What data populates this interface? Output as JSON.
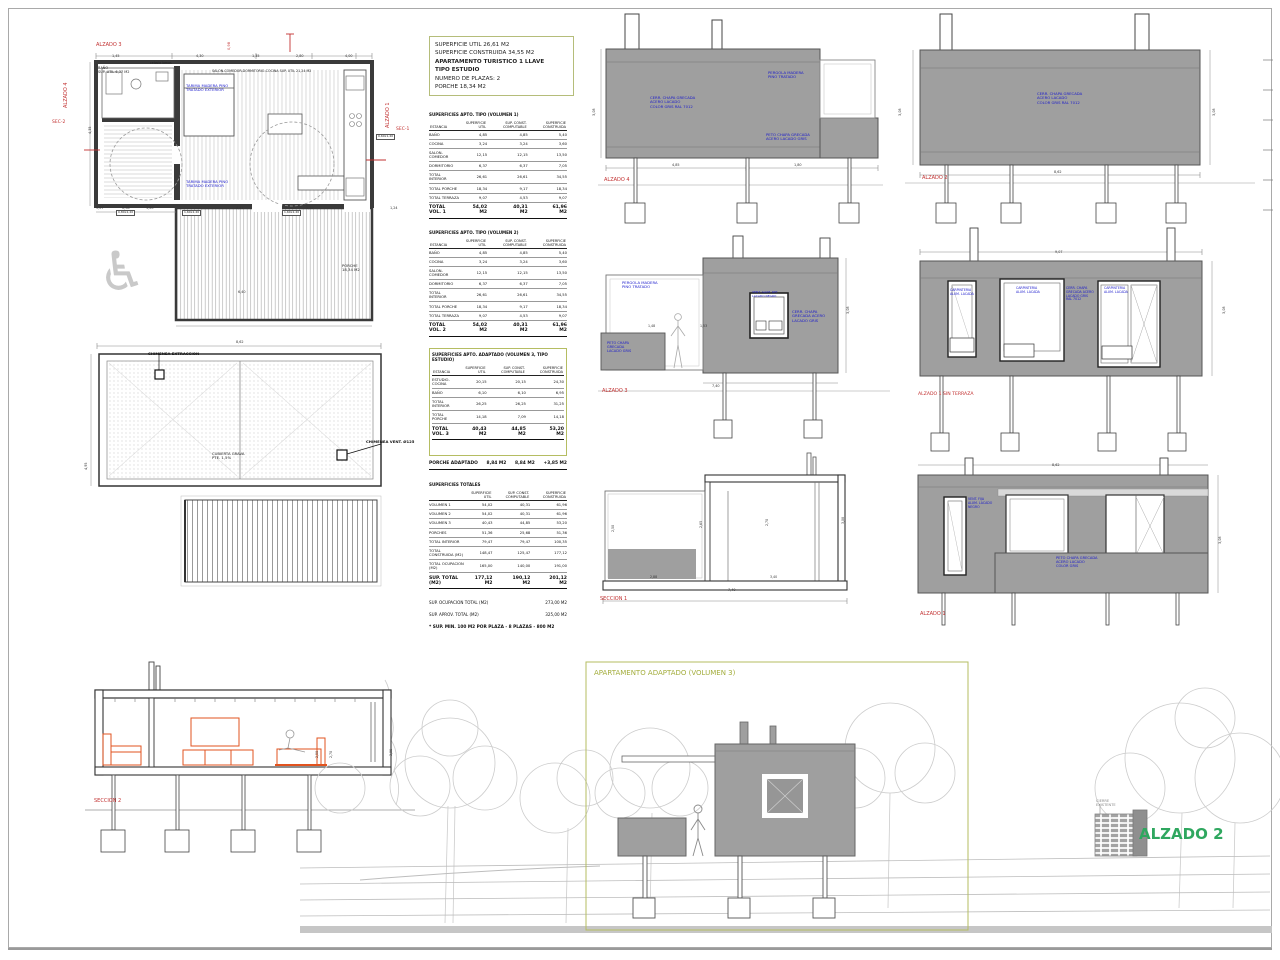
{
  "colors": {
    "red": "#c23030",
    "blue": "#1a1acc",
    "olive": "#a3ad3c",
    "green": "#2fa75f",
    "wall": "#9f9f9f",
    "orange": "#e2531f"
  },
  "summary": {
    "lines": [
      "SUPERFICIE UTIL 26,61 M2",
      "SUPERFICIE CONSTRUIDA 34,55 M2",
      "APARTAMENTO TURISTICO 1 LLAVE",
      "TIPO ESTUDIO",
      "NUMERO DE PLAZAS: 2",
      "PORCHE 18,34 M2"
    ]
  },
  "table_order": [
    "t1",
    "t2",
    "t3",
    "t4"
  ],
  "tables": {
    "t1": {
      "name": "surface-table-vol1",
      "title": "SUPERFICIES APTO. TIPO (VOLUMEN 1)",
      "unit": "M2",
      "col_headers": [
        "ESTANCIA",
        "SUPERFICIE UTIL",
        "SUP. CONST. COMPUTABLE",
        "SUPERFICIE CONSTRUIDA"
      ],
      "rows": [
        [
          "BAÑO",
          "4,85",
          "4,85",
          "5,40"
        ],
        [
          "COCINA",
          "3,24",
          "3,24",
          "3,60"
        ],
        [
          "SALON-COMEDOR",
          "12,15",
          "12,15",
          "13,50"
        ],
        [
          "DORMITORIO",
          "6,37",
          "6,37",
          "7,05"
        ],
        [
          "TOTAL INTERIOR",
          "26,61",
          "26,61",
          "34,55"
        ],
        [
          "TOTAL PORCHE",
          "18,34",
          "9,17",
          "18,34"
        ],
        [
          "TOTAL TERRAZA",
          "9,07",
          "4,53",
          "9,07"
        ]
      ],
      "total": {
        "label": "TOTAL\nVOL. 1",
        "values": [
          "54,02",
          "40,31",
          "61,96"
        ]
      }
    },
    "t2": {
      "name": "surface-table-vol2",
      "title": "SUPERFICIES APTO. TIPO (VOLUMEN 2)",
      "unit": "M2",
      "col_headers": [
        "ESTANCIA",
        "SUPERFICIE UTIL",
        "SUP. CONST. COMPUTABLE",
        "SUPERFICIE CONSTRUIDA"
      ],
      "rows": [
        [
          "BAÑO",
          "4,85",
          "4,85",
          "5,40"
        ],
        [
          "COCINA",
          "3,24",
          "3,24",
          "3,60"
        ],
        [
          "SALON-COMEDOR",
          "12,15",
          "12,15",
          "13,50"
        ],
        [
          "DORMITORIO",
          "6,37",
          "6,37",
          "7,05"
        ],
        [
          "TOTAL INTERIOR",
          "26,61",
          "26,61",
          "34,55"
        ],
        [
          "TOTAL PORCHE",
          "18,34",
          "9,17",
          "18,34"
        ],
        [
          "TOTAL TERRAZA",
          "9,07",
          "4,53",
          "9,07"
        ]
      ],
      "total": {
        "label": "TOTAL\nVOL. 2",
        "values": [
          "54,02",
          "40,31",
          "61,96"
        ]
      }
    },
    "t3": {
      "name": "surface-table-vol3",
      "boxed": true,
      "title": "SUPERFICIES APTO. ADAPTADO (VOLUMEN 3, TIPO ESTUDIO)",
      "unit": "M2",
      "col_headers": [
        "ESTANCIA",
        "SUPERFICIE UTIL",
        "SUP. CONST. COMPUTABLE",
        "SUPERFICIE CONSTRUIDA"
      ],
      "rows": [
        [
          "ESTUDIO-COCINA",
          "20,15",
          "20,15",
          "24,30"
        ],
        [
          "BAÑO",
          "6,10",
          "6,10",
          "6,95"
        ],
        [
          "TOTAL INTERIOR",
          "26,25",
          "26,25",
          "31,25"
        ],
        [
          "TOTAL PORCHE",
          "14,18",
          "7,09",
          "14,18"
        ]
      ],
      "total": {
        "label": "TOTAL\nVOL. 3",
        "values": [
          "40,43",
          "44,85",
          "53,20"
        ]
      },
      "extra_row": [
        "PORCHE ADAPTADO",
        "8,84 M2",
        "8,84 M2",
        "+3,85 M2"
      ]
    },
    "t4": {
      "name": "surface-table-totals",
      "title": "SUPERFICIES TOTALES",
      "unit": "M2",
      "col_headers": [
        "",
        "SUPERFICIE UTIL",
        "SUP. CONST. COMPUTABLE",
        "SUPERFICIE CONSTRUIDA"
      ],
      "rows": [
        [
          "VOLUMEN 1",
          "54,02",
          "40,31",
          "61,96"
        ],
        [
          "VOLUMEN 2",
          "54,02",
          "40,31",
          "61,96"
        ],
        [
          "VOLUMEN 3",
          "40,43",
          "44,85",
          "53,20"
        ],
        [
          "PORCHES",
          "51,36",
          "25,68",
          "51,36"
        ],
        [
          "TOTAL INTERIOR",
          "79,47",
          "79,47",
          "100,35"
        ],
        [
          "TOTAL CONSTRUIDA (M2)",
          "148,47",
          "125,47",
          "177,12"
        ],
        [
          "TOTAL OCUPACION (M2)",
          "165,00",
          "140,00",
          "191,00"
        ]
      ],
      "total": {
        "label": "SUP. TOTAL\n(M2)",
        "values": [
          "177,12",
          "190,12",
          "201,12"
        ]
      },
      "footer_lines": [
        [
          "SUP. OCUPACION TOTAL (M2)",
          "273,00 M2"
        ],
        [
          "SUP. APROV. TOTAL (M2)",
          "325,00 M2"
        ]
      ],
      "final_line": "* SUP. MIN. 100 M2 POR PLAZA - 8 PLAZAS - 800 M2"
    }
  },
  "labels": [
    {
      "n": "plan-alzado3-label",
      "t": "ALZADO 3",
      "x": 96,
      "y": 43,
      "s": 5,
      "c": "red"
    },
    {
      "n": "plan-alzado4-label",
      "t": "ALZADO 4",
      "x": 64,
      "y": 108,
      "s": 5,
      "c": "red",
      "r": -90
    },
    {
      "n": "plan-alzado1-label",
      "t": "ALZADO 1",
      "x": 386,
      "y": 128,
      "s": 5,
      "c": "red",
      "r": -90
    },
    {
      "n": "plan-sec2-label",
      "t": "SEC-2",
      "x": 52,
      "y": 120,
      "s": 4.5,
      "c": "red"
    },
    {
      "n": "plan-sec1-label",
      "t": "SEC-1",
      "x": 396,
      "y": 127,
      "s": 4.5,
      "c": "red"
    },
    {
      "n": "plan-red-dim",
      "t": "0,98",
      "x": 227,
      "y": 50,
      "s": 3.6,
      "c": "red",
      "r": -90
    },
    {
      "n": "plan-bano-label",
      "t": "BAÑO\nSUP. UTIL 6,37 M2",
      "x": 98,
      "y": 66,
      "s": 3.5,
      "c": "#222"
    },
    {
      "n": "plan-salon-label",
      "t": "SALON-COMEDOR-DORMITORIO-COCINA  SUP. UTIL 21,24 M2",
      "x": 212,
      "y": 70,
      "s": 3.3,
      "c": "#222"
    },
    {
      "n": "plan-celosia-label",
      "t": "celosia lamas",
      "x": 150,
      "y": 62,
      "s": 3.2,
      "c": "#222"
    },
    {
      "n": "plan-note-1",
      "t": "TARIMA MADERA PINO\nTRATADO EXTERIOR",
      "x": 186,
      "y": 84,
      "s": 3.8,
      "c": "blue"
    },
    {
      "n": "plan-note-2",
      "t": "TARIMA MADERA PINO\nTRATADO EXTERIOR",
      "x": 186,
      "y": 180,
      "s": 3.8,
      "c": "blue"
    },
    {
      "n": "plan-porche-label",
      "t": "PORCHE\n18,34 M2",
      "x": 342,
      "y": 264,
      "s": 3.8,
      "c": "#222"
    },
    {
      "n": "dim",
      "t": "5,07",
      "x": 96,
      "y": 206,
      "s": 3.4
    },
    {
      "n": "dim",
      "t": "0,98",
      "x": 122,
      "y": 206,
      "s": 3.4
    },
    {
      "n": "dim",
      "t": "1,20",
      "x": 146,
      "y": 206,
      "s": 3.4
    },
    {
      "n": "dim",
      "t": "4,47",
      "x": 236,
      "y": 206,
      "s": 3.4
    },
    {
      "n": "dim",
      "t": "1,39",
      "x": 306,
      "y": 206,
      "s": 3.4
    },
    {
      "n": "dim",
      "t": "1,24",
      "x": 390,
      "y": 206,
      "s": 3.4
    },
    {
      "n": "dim",
      "t": "1,45",
      "x": 112,
      "y": 54,
      "s": 3.4
    },
    {
      "n": "dim",
      "t": "4,30",
      "x": 196,
      "y": 54,
      "s": 3.4
    },
    {
      "n": "dim",
      "t": "1,35",
      "x": 252,
      "y": 54,
      "s": 3.4
    },
    {
      "n": "dim",
      "t": "2,80",
      "x": 296,
      "y": 54,
      "s": 3.4
    },
    {
      "n": "dim",
      "t": "4,00",
      "x": 345,
      "y": 54,
      "s": 3.4
    },
    {
      "n": "dim",
      "t": "4,35",
      "x": 88,
      "y": 134,
      "s": 3.4,
      "r": -90
    },
    {
      "n": "dim",
      "t": "6,40",
      "x": 238,
      "y": 290,
      "s": 3.4
    },
    {
      "n": "door-chip",
      "t": "1,60x2,20",
      "x": 182,
      "y": 210,
      "s": 3,
      "c": "#222",
      "chip": 1
    },
    {
      "n": "door-chip",
      "t": "1,60x2,20",
      "x": 282,
      "y": 210,
      "s": 3,
      "c": "#222",
      "chip": 1
    },
    {
      "n": "door-chip",
      "t": "0,80x2,20",
      "x": 116,
      "y": 210,
      "s": 3,
      "c": "#222",
      "chip": 1
    },
    {
      "n": "window-chip",
      "t": "0,60x1,20",
      "x": 376,
      "y": 134,
      "s": 3,
      "c": "#222",
      "chip": 1
    },
    {
      "n": "wheelchair-icon",
      "t": "♿",
      "x": 98,
      "y": 240,
      "s": 54,
      "c": "#c9c9c9"
    },
    {
      "n": "roof-chimenea1-label",
      "t": "CHIMENEA EXTRACCION",
      "x": 148,
      "y": 352,
      "s": 3.8,
      "c": "#111",
      "b": 1
    },
    {
      "n": "roof-chimenea2-label",
      "t": "CHIMENEA VENT. Ø125",
      "x": 366,
      "y": 440,
      "s": 3.8,
      "c": "#111",
      "b": 1
    },
    {
      "n": "roof-center-label",
      "t": "CUBIERTA GRAVA\nPTE. 1,5%",
      "x": 212,
      "y": 452,
      "s": 3.8,
      "c": "#222"
    },
    {
      "n": "dim",
      "t": "8,62",
      "x": 236,
      "y": 340,
      "s": 3.4
    },
    {
      "n": "dim",
      "t": "4,95",
      "x": 84,
      "y": 470,
      "s": 3.4,
      "r": -90
    },
    {
      "n": "seccion2-label",
      "t": "SECCION 2",
      "x": 94,
      "y": 799,
      "s": 5,
      "c": "red"
    },
    {
      "n": "dim",
      "t": "2,50",
      "x": 316,
      "y": 758,
      "s": 3.2,
      "r": -90
    },
    {
      "n": "dim",
      "t": "2,70",
      "x": 330,
      "y": 758,
      "s": 3.2,
      "r": -90
    },
    {
      "n": "dim",
      "t": "3,08",
      "x": 390,
      "y": 756,
      "s": 3.2,
      "r": -90
    },
    {
      "n": "alzado4-label",
      "t": "ALZADO 4",
      "x": 604,
      "y": 178,
      "s": 5,
      "c": "red"
    },
    {
      "n": "alzado4-note1",
      "t": "CERR. CHAPA GRECADA\nACERO LACADO\nCOLOR GRIS RAL 7012",
      "x": 650,
      "y": 96,
      "s": 3.8,
      "c": "blue"
    },
    {
      "n": "alzado4-note2",
      "t": "PERGOLA MADERA\nPINO TRATADO",
      "x": 768,
      "y": 71,
      "s": 3.8,
      "c": "blue"
    },
    {
      "n": "alzado4-note3",
      "t": "PETO CHAPA GRECADA\nACERO LACADO GRIS",
      "x": 766,
      "y": 133,
      "s": 3.8,
      "c": "blue"
    },
    {
      "n": "dim",
      "t": "4,85",
      "x": 672,
      "y": 163,
      "s": 3.4
    },
    {
      "n": "dim",
      "t": "1,80",
      "x": 794,
      "y": 163,
      "s": 3.4
    },
    {
      "n": "dim",
      "t": "3,08",
      "x": 592,
      "y": 116,
      "s": 3.4,
      "r": -90
    },
    {
      "n": "alzado2-elev-label",
      "t": "ALZADO 2",
      "x": 922,
      "y": 176,
      "s": 5,
      "c": "red"
    },
    {
      "n": "alzado2-note",
      "t": "CERR. CHAPA GRECADA\nACERO LACADO\nCOLOR GRIS RAL 7012",
      "x": 1037,
      "y": 92,
      "s": 3.8,
      "c": "blue"
    },
    {
      "n": "dim",
      "t": "8,62",
      "x": 1054,
      "y": 170,
      "s": 3.4
    },
    {
      "n": "dim",
      "t": "3,08",
      "x": 898,
      "y": 116,
      "s": 3.4,
      "r": -90
    },
    {
      "n": "dim",
      "t": "3,08",
      "x": 1212,
      "y": 116,
      "s": 3.4,
      "r": -90
    },
    {
      "n": "alzado3-label",
      "t": "ALZADO 3",
      "x": 602,
      "y": 389,
      "s": 5,
      "c": "red"
    },
    {
      "n": "alzado3-note1",
      "t": "PERGOLA MADERA\nPINO TRATADO",
      "x": 622,
      "y": 281,
      "s": 3.8,
      "c": "blue"
    },
    {
      "n": "alzado3-note2",
      "t": "VENT. ALUM. RPT\nLACADO NEGRO",
      "x": 752,
      "y": 291,
      "s": 3,
      "c": "blue"
    },
    {
      "n": "alzado3-note3",
      "t": "CERR. CHAPA\nGRECADA ACERO\nLACADO GRIS",
      "x": 792,
      "y": 310,
      "s": 3.8,
      "c": "blue"
    },
    {
      "n": "alzado3-note4",
      "t": "PETO CHAPA\nGRECADA\nLACADO GRIS",
      "x": 607,
      "y": 341,
      "s": 3.5,
      "c": "blue"
    },
    {
      "n": "dim",
      "t": "1,48",
      "x": 648,
      "y": 325,
      "s": 3.2
    },
    {
      "n": "dim",
      "t": "1,53",
      "x": 700,
      "y": 325,
      "s": 3.2
    },
    {
      "n": "dim",
      "t": "7,40",
      "x": 712,
      "y": 384,
      "s": 3.4
    },
    {
      "n": "dim",
      "t": "3,08",
      "x": 846,
      "y": 314,
      "s": 3.4,
      "r": -90
    },
    {
      "n": "alzado1st-label",
      "t": "ALZADO 1 SIN TERRAZA",
      "x": 918,
      "y": 392,
      "s": 4.6,
      "c": "red"
    },
    {
      "n": "dim",
      "t": "9,07",
      "x": 1055,
      "y": 250,
      "s": 3.4
    },
    {
      "n": "alzado1st-note1",
      "t": "CARPINTERIA\nALUM. LACADA",
      "x": 950,
      "y": 289,
      "s": 3.2,
      "c": "blue"
    },
    {
      "n": "alzado1st-note2",
      "t": "CARPINTERIA\nALUM. LACADA",
      "x": 1016,
      "y": 287,
      "s": 3.2,
      "c": "blue"
    },
    {
      "n": "alzado1st-note3",
      "t": "CERR. CHAPA\nGRECADA ACERO\nLACADO GRIS\nRAL 7012",
      "x": 1066,
      "y": 287,
      "s": 3.2,
      "c": "blue"
    },
    {
      "n": "alzado1st-note4",
      "t": "CARPINTERIA\nALUM. LACADA",
      "x": 1104,
      "y": 287,
      "s": 3.2,
      "c": "blue"
    },
    {
      "n": "dim",
      "t": "3,08",
      "x": 1222,
      "y": 314,
      "s": 3.4,
      "r": -90
    },
    {
      "n": "seccion1-label",
      "t": "SECCION 1",
      "x": 600,
      "y": 597,
      "s": 5,
      "c": "red"
    },
    {
      "n": "dim",
      "t": "7,40",
      "x": 728,
      "y": 588,
      "s": 3.4
    },
    {
      "n": "dim",
      "t": "2,88",
      "x": 650,
      "y": 576,
      "s": 3.2
    },
    {
      "n": "dim",
      "t": "3,40",
      "x": 770,
      "y": 576,
      "s": 3.2
    },
    {
      "n": "dim",
      "t": "2,50",
      "x": 612,
      "y": 532,
      "s": 3.2,
      "r": -90
    },
    {
      "n": "dim",
      "t": "2,65",
      "x": 700,
      "y": 528,
      "s": 3.2,
      "r": -90
    },
    {
      "n": "dim",
      "t": "2,70",
      "x": 766,
      "y": 526,
      "s": 3.2,
      "r": -90
    },
    {
      "n": "dim",
      "t": "3,08",
      "x": 842,
      "y": 524,
      "s": 3.2,
      "r": -90
    },
    {
      "n": "alzado1-label",
      "t": "ALZADO 1",
      "x": 920,
      "y": 612,
      "s": 5,
      "c": "red"
    },
    {
      "n": "dim",
      "t": "8,62",
      "x": 1052,
      "y": 463,
      "s": 3.4
    },
    {
      "n": "alzado1-note1",
      "t": "VENT. FIJA\nALUM. LACADO\nNEGRO",
      "x": 968,
      "y": 498,
      "s": 3.2,
      "c": "blue"
    },
    {
      "n": "alzado1-note2",
      "t": "PETO CHAPA GRECADA\nACERO LACADO\nCOLOR GRIS",
      "x": 1056,
      "y": 556,
      "s": 3.6,
      "c": "blue"
    },
    {
      "n": "dim",
      "t": "3,08",
      "x": 1218,
      "y": 544,
      "s": 3.4,
      "r": -90
    },
    {
      "n": "adapted-volume-title",
      "t": "APARTAMENTO ADAPTADO (VOLUMEN 3)",
      "x": 594,
      "y": 669,
      "s": 7,
      "c": "olive"
    },
    {
      "n": "alzado2-render-label",
      "t": "ALZADO 2",
      "x": 1139,
      "y": 826,
      "s": 15,
      "c": "green",
      "b": 1
    },
    {
      "n": "cierre-existente-label",
      "t": "CIERRE\nEXISTENTE",
      "x": 1096,
      "y": 799,
      "s": 3.6,
      "c": "#8a8a8a"
    }
  ]
}
